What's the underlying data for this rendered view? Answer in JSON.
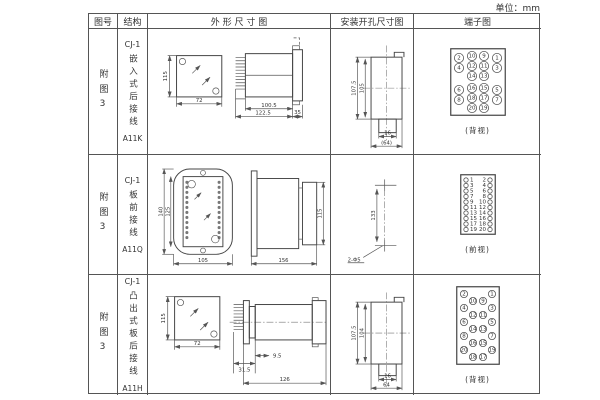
{
  "unit_label": "单位：mm",
  "table": {
    "headers": [
      "图号",
      "结构",
      "外 形 尺 寸 图",
      "安装开孔尺寸图",
      "端子图"
    ]
  },
  "rows": [
    {
      "fig": "附图3",
      "model": "CJ-1",
      "structure": "嵌入式后接线",
      "code": "A11K",
      "outline": {
        "front_h": "115",
        "front_w": "72",
        "side_inner": "100.5",
        "side_overall": "122.5",
        "side_flange": "35"
      },
      "install": {
        "h_outer": "107.5",
        "h_inner": "105",
        "w_inner": "16",
        "w_outer": "(64)"
      },
      "terminal": {
        "caption": "(背视)"
      }
    },
    {
      "fig": "附图3",
      "model": "CJ-1",
      "structure": "板前接线",
      "code": "A11Q",
      "outline": {
        "front_h_outer": "140",
        "front_h_inner": "125",
        "front_w": "105",
        "side_len": "156",
        "side_h": "115"
      },
      "install": {
        "h": "133",
        "holes": "2-Φ5"
      },
      "terminal": {
        "caption": "(前视)"
      }
    },
    {
      "fig": "附图3",
      "model": "CJ-1",
      "structure": "凸出式板后接线",
      "code": "A11H",
      "outline": {
        "front_h": "115",
        "front_w": "72",
        "side_d1": "31.5",
        "side_d2": "9.5",
        "side_len": "126"
      },
      "install": {
        "h_outer": "107.5",
        "h_inner": "104",
        "w_inner": "16",
        "w_outer": "64"
      },
      "terminal": {
        "caption": "(背视)"
      }
    }
  ],
  "terminals": {
    "back1": {
      "w": 56,
      "h": 68,
      "r": 4.6,
      "fs": 4.5,
      "items": [
        {
          "x": 9,
          "y": 10,
          "n": "2"
        },
        {
          "x": 9,
          "y": 20,
          "n": "4"
        },
        {
          "x": 9,
          "y": 42,
          "n": "6"
        },
        {
          "x": 9,
          "y": 52,
          "n": "8"
        },
        {
          "x": 22,
          "y": 8,
          "n": "10"
        },
        {
          "x": 22,
          "y": 18,
          "n": "12"
        },
        {
          "x": 22,
          "y": 28,
          "n": "14"
        },
        {
          "x": 22,
          "y": 40,
          "n": "16"
        },
        {
          "x": 22,
          "y": 50,
          "n": "18"
        },
        {
          "x": 22,
          "y": 60,
          "n": "20"
        },
        {
          "x": 34,
          "y": 8,
          "n": "9"
        },
        {
          "x": 34,
          "y": 18,
          "n": "11"
        },
        {
          "x": 34,
          "y": 28,
          "n": "13"
        },
        {
          "x": 34,
          "y": 40,
          "n": "15"
        },
        {
          "x": 34,
          "y": 50,
          "n": "17"
        },
        {
          "x": 34,
          "y": 60,
          "n": "19"
        },
        {
          "x": 47,
          "y": 10,
          "n": "1"
        },
        {
          "x": 47,
          "y": 20,
          "n": "3"
        },
        {
          "x": 47,
          "y": 42,
          "n": "5"
        },
        {
          "x": 47,
          "y": 52,
          "n": "7"
        }
      ]
    },
    "front2": {
      "w": 36,
      "h": 61,
      "r": 2.2,
      "fs": 4.2,
      "items": [
        {
          "x": 6,
          "y": 6,
          "n": "1",
          "lx": 10,
          "a": "start"
        },
        {
          "x": 30,
          "y": 6,
          "n": "2",
          "lx": 26,
          "a": "end"
        },
        {
          "x": 6,
          "y": 11.5,
          "n": "3",
          "lx": 10,
          "a": "start"
        },
        {
          "x": 30,
          "y": 11.5,
          "n": "4",
          "lx": 26,
          "a": "end"
        },
        {
          "x": 6,
          "y": 17,
          "n": "5",
          "lx": 10,
          "a": "start"
        },
        {
          "x": 30,
          "y": 17,
          "n": "6",
          "lx": 26,
          "a": "end"
        },
        {
          "x": 6,
          "y": 22.5,
          "n": "7",
          "lx": 10,
          "a": "start"
        },
        {
          "x": 30,
          "y": 22.5,
          "n": "8",
          "lx": 26,
          "a": "end"
        },
        {
          "x": 6,
          "y": 28,
          "n": "9",
          "lx": 10,
          "a": "start"
        },
        {
          "x": 30,
          "y": 28,
          "n": "10",
          "lx": 26,
          "a": "end"
        },
        {
          "x": 6,
          "y": 33.5,
          "n": "11",
          "lx": 10,
          "a": "start"
        },
        {
          "x": 30,
          "y": 33.5,
          "n": "12",
          "lx": 26,
          "a": "end"
        },
        {
          "x": 6,
          "y": 39,
          "n": "13",
          "lx": 10,
          "a": "start"
        },
        {
          "x": 30,
          "y": 39,
          "n": "14",
          "lx": 26,
          "a": "end"
        },
        {
          "x": 6,
          "y": 44.5,
          "n": "15",
          "lx": 10,
          "a": "start"
        },
        {
          "x": 30,
          "y": 44.5,
          "n": "16",
          "lx": 26,
          "a": "end"
        },
        {
          "x": 6,
          "y": 50,
          "n": "17",
          "lx": 10,
          "a": "start"
        },
        {
          "x": 30,
          "y": 50,
          "n": "18",
          "lx": 26,
          "a": "end"
        },
        {
          "x": 6,
          "y": 55.5,
          "n": "19",
          "lx": 10,
          "a": "start"
        },
        {
          "x": 30,
          "y": 55.5,
          "n": "20",
          "lx": 26,
          "a": "end"
        }
      ]
    },
    "back3": {
      "w": 44,
      "h": 79,
      "r": 3.6,
      "fs": 4,
      "items": [
        {
          "x": 8,
          "y": 8,
          "n": "2"
        },
        {
          "x": 8,
          "y": 22,
          "n": "4"
        },
        {
          "x": 8,
          "y": 36,
          "n": "6"
        },
        {
          "x": 8,
          "y": 50,
          "n": "8"
        },
        {
          "x": 8,
          "y": 64,
          "n": "20"
        },
        {
          "x": 17,
          "y": 15,
          "n": "10"
        },
        {
          "x": 17,
          "y": 29,
          "n": "12"
        },
        {
          "x": 17,
          "y": 43,
          "n": "14"
        },
        {
          "x": 17,
          "y": 57,
          "n": "16"
        },
        {
          "x": 17,
          "y": 71,
          "n": "18"
        },
        {
          "x": 27,
          "y": 15,
          "n": "9"
        },
        {
          "x": 27,
          "y": 29,
          "n": "11"
        },
        {
          "x": 27,
          "y": 43,
          "n": "13"
        },
        {
          "x": 27,
          "y": 57,
          "n": "15"
        },
        {
          "x": 27,
          "y": 71,
          "n": "17"
        },
        {
          "x": 36,
          "y": 8,
          "n": "1"
        },
        {
          "x": 36,
          "y": 22,
          "n": "3"
        },
        {
          "x": 36,
          "y": 36,
          "n": "5"
        },
        {
          "x": 36,
          "y": 50,
          "n": "7"
        },
        {
          "x": 36,
          "y": 64,
          "n": "19"
        }
      ]
    }
  }
}
